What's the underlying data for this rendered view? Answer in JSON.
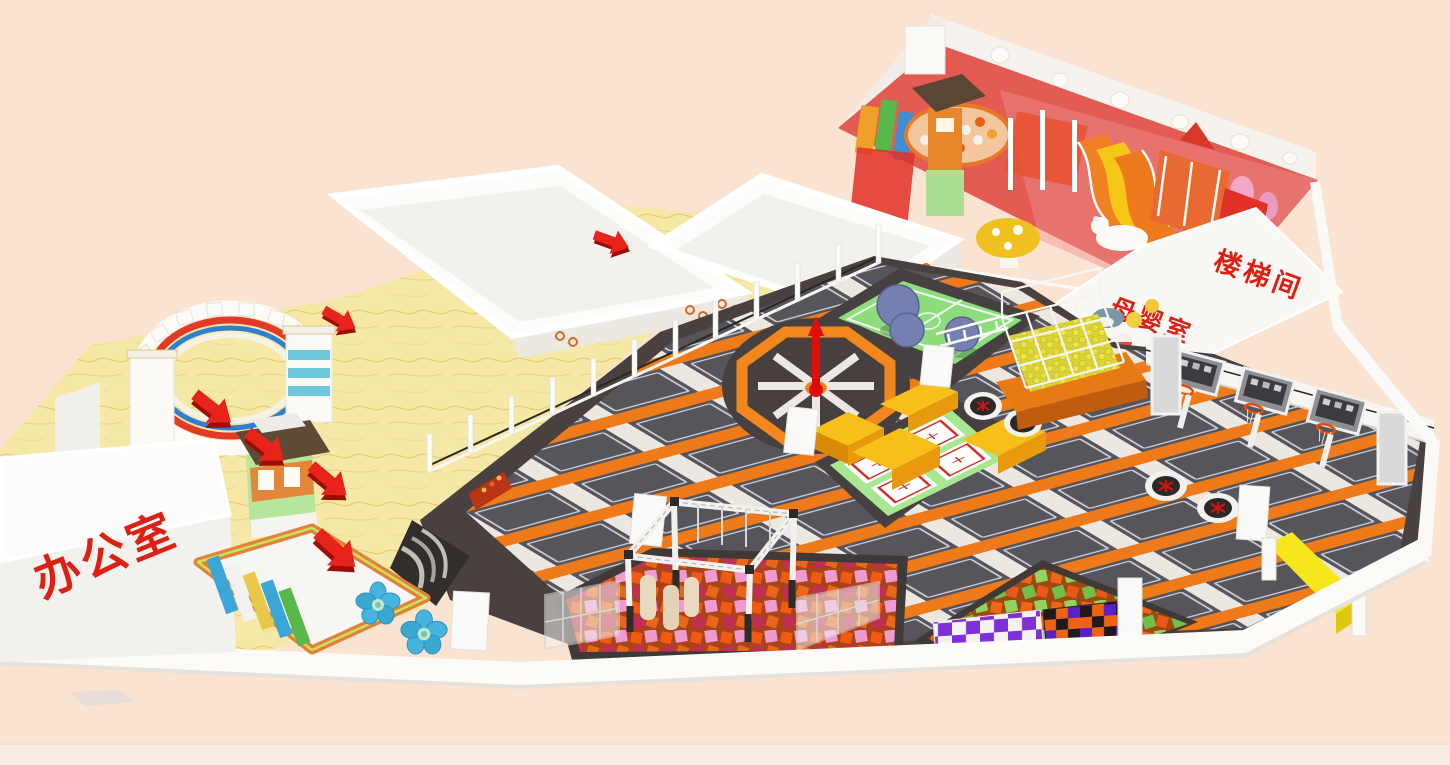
{
  "scene": {
    "description": "3D isometric rendering of an indoor kids playground and trampoline park floor plan",
    "background_color": "#fbe3d2",
    "baseboard_color": "#f7ece1"
  },
  "labels": {
    "office": {
      "text": "办公室",
      "color": "#dc2114"
    },
    "nursing_room": {
      "text": "母婴室",
      "color": "#dc2114"
    },
    "stairwell": {
      "text": "楼梯间",
      "color": "#dc2114"
    }
  },
  "palette": {
    "platform_dark": "#494140",
    "trampoline_mat": "#57555b",
    "mat_outline": "#c7cdd6",
    "padding_orange": "#ee7a1a",
    "walkway_white": "#ece7e0",
    "lobby_floor_yellow": "#f6e8a6",
    "marble_vein": "#e3cb6e",
    "wall_white": "#fbfaf7",
    "accent_red": "#e02315",
    "arrow_red": "#e7231a",
    "court_green": "#8ddd7d",
    "protramp_green": "#a7e790",
    "wrecking_ball_blue": "#767fb2",
    "octagon_orange": "#f1871d",
    "foam_orange": "#f05a14",
    "foam_pink": "#f09ad2",
    "foam_green": "#8fd45c",
    "checker_purple": "#7e2fd8",
    "beam_yellow": "#f6e71c",
    "cage_ball_yellow": "#e8de3e",
    "flower_seat_blue": "#45b5dd",
    "kiosk_green": "#b6e69c",
    "kiosk_roof_brown": "#5f4a36",
    "castle_teal": "#5cc3d6",
    "rainbow_red": "#e23a28",
    "rainbow_blue": "#2e7ed2",
    "softplay_floor_red": "#e25c54",
    "slide_orange": "#f08024",
    "slide_yellow": "#f5c818"
  },
  "zones": [
    "entrance-arch",
    "lobby",
    "office",
    "ticket-kiosk",
    "shoe-rack",
    "flower-seats",
    "white-platform-a",
    "white-platform-b",
    "kids-softplay-zone",
    "stairwell",
    "nursing-room",
    "main-trampoline-court",
    "wrecking-ball-court",
    "sweeper-wheel",
    "performance-trampolines",
    "target-trampolines",
    "dunk-lanes",
    "ball-cage-tower",
    "ninja-truss",
    "foam-pit-center",
    "foam-pit-right",
    "checker-wall",
    "yellow-beam",
    "flow-arrows",
    "front-wall"
  ]
}
